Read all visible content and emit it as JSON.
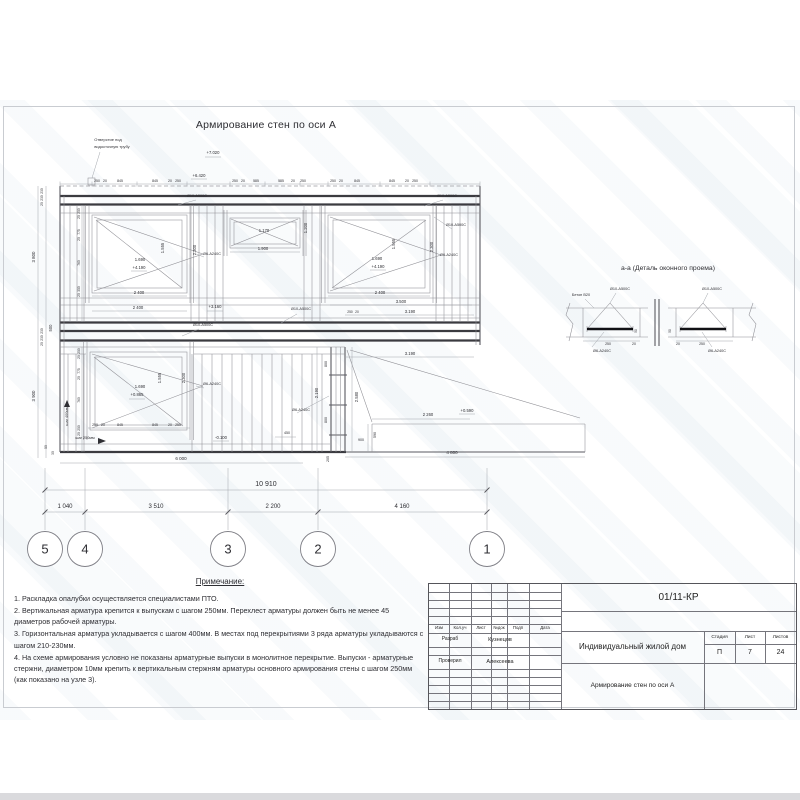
{
  "drawing": {
    "title": "Армирование стен по оси А",
    "labels": [
      [
        "Отверстие под",
        108,
        141,
        {
          "s": 4
        }
      ],
      [
        "водосточную трубу",
        112,
        148,
        {
          "s": 4
        }
      ],
      [
        "+7.020",
        213,
        154
      ],
      [
        "+6.420",
        199,
        177
      ],
      [
        "250",
        97,
        182,
        {
          "s": 3.5
        }
      ],
      [
        "20",
        105,
        182,
        {
          "s": 3.5
        }
      ],
      [
        "845",
        120,
        182,
        {
          "s": 3.5
        }
      ],
      [
        "845",
        155,
        182,
        {
          "s": 3.5
        }
      ],
      [
        "20",
        170,
        182,
        {
          "s": 3.5
        }
      ],
      [
        "250",
        178,
        182,
        {
          "s": 3.5
        }
      ],
      [
        "250",
        235,
        182,
        {
          "s": 3.5
        }
      ],
      [
        "20",
        243,
        182,
        {
          "s": 3.5
        }
      ],
      [
        "585",
        256,
        182,
        {
          "s": 3.5
        }
      ],
      [
        "585",
        281,
        182,
        {
          "s": 3.5
        }
      ],
      [
        "20",
        293,
        182,
        {
          "s": 3.5
        }
      ],
      [
        "250",
        303,
        182,
        {
          "s": 3.5
        }
      ],
      [
        "250",
        333,
        182,
        {
          "s": 3.5
        }
      ],
      [
        "20",
        341,
        182,
        {
          "s": 3.5
        }
      ],
      [
        "845",
        357,
        182,
        {
          "s": 3.5
        }
      ],
      [
        "845",
        392,
        182,
        {
          "s": 3.5
        }
      ],
      [
        "20",
        407,
        182,
        {
          "s": 3.5
        }
      ],
      [
        "250",
        415,
        182,
        {
          "s": 3.5
        }
      ],
      [
        "Ø10-A500C",
        197,
        197,
        {
          "s": 3.8
        }
      ],
      [
        "Ø10-A500C",
        447,
        197,
        {
          "s": 3.8
        }
      ],
      [
        "Ø10-A500C",
        456,
        226,
        {
          "s": 3.8
        }
      ],
      [
        "Ø6-A240C",
        449,
        256,
        {
          "s": 3.8
        }
      ],
      [
        "Ø6-A240C",
        212,
        255,
        {
          "s": 3.8
        }
      ],
      [
        "1.555",
        164,
        248,
        {
          "r": 1
        }
      ],
      [
        "2.300",
        196,
        250,
        {
          "r": 1
        }
      ],
      [
        "1.690",
        140,
        261
      ],
      [
        "+4.190",
        139,
        269
      ],
      [
        "2 400",
        139,
        294
      ],
      [
        "1.170",
        264,
        232
      ],
      [
        "1.900",
        263,
        250
      ],
      [
        "1.200",
        307,
        228,
        {
          "r": 1
        }
      ],
      [
        "1.555",
        395,
        244,
        {
          "r": 1
        }
      ],
      [
        "2.300",
        433,
        247,
        {
          "r": 1
        }
      ],
      [
        "1.690",
        377,
        260
      ],
      [
        "+4.190",
        378,
        268
      ],
      [
        "2 400",
        380,
        294
      ],
      [
        "2 400",
        138,
        309
      ],
      [
        "+3.160",
        215,
        308
      ],
      [
        "3.500",
        401,
        303
      ],
      [
        "250",
        350,
        313,
        {
          "s": 3.3
        }
      ],
      [
        "20",
        357,
        313,
        {
          "s": 3.3
        }
      ],
      [
        "3.190",
        410,
        313
      ],
      [
        "Ø10-A500C",
        301,
        310,
        {
          "s": 3.8
        }
      ],
      [
        "230",
        43,
        191,
        {
          "r": 1,
          "s": 3.3
        }
      ],
      [
        "230",
        43,
        198,
        {
          "r": 1,
          "s": 3.3
        }
      ],
      [
        "20",
        43,
        204,
        {
          "r": 1,
          "s": 3.3
        }
      ],
      [
        "3 800",
        35,
        257,
        {
          "r": 1,
          "s": 4.4
        }
      ],
      [
        "500",
        52,
        328,
        {
          "r": 1
        }
      ],
      [
        "230",
        43,
        331,
        {
          "r": 1,
          "s": 3.3
        }
      ],
      [
        "230",
        43,
        338,
        {
          "r": 1,
          "s": 3.3
        }
      ],
      [
        "20",
        43,
        344,
        {
          "r": 1,
          "s": 3.3
        }
      ],
      [
        "3 900",
        35,
        396,
        {
          "r": 1,
          "s": 4.4
        }
      ],
      [
        "50",
        47,
        447,
        {
          "r": 1,
          "s": 3.3
        }
      ],
      [
        "30",
        54,
        453,
        {
          "r": 1,
          "s": 3.3
        }
      ],
      [
        "250",
        80,
        211,
        {
          "r": 1,
          "s": 3.3
        }
      ],
      [
        "20",
        80,
        217,
        {
          "r": 1,
          "s": 3.3
        }
      ],
      [
        "775",
        80,
        232,
        {
          "r": 1,
          "s": 3.3
        }
      ],
      [
        "20",
        80,
        239,
        {
          "r": 1,
          "s": 3.3
        }
      ],
      [
        "760",
        80,
        263,
        {
          "r": 1,
          "s": 3.3
        }
      ],
      [
        "350",
        80,
        289,
        {
          "r": 1,
          "s": 3.3
        }
      ],
      [
        "20",
        80,
        295,
        {
          "r": 1,
          "s": 3.3
        }
      ],
      [
        "250",
        80,
        351,
        {
          "r": 1,
          "s": 3.3
        }
      ],
      [
        "20",
        80,
        357,
        {
          "r": 1,
          "s": 3.3
        }
      ],
      [
        "775",
        80,
        371,
        {
          "r": 1,
          "s": 3.3
        }
      ],
      [
        "20",
        80,
        378,
        {
          "r": 1,
          "s": 3.3
        }
      ],
      [
        "760",
        80,
        400,
        {
          "r": 1,
          "s": 3.3
        }
      ],
      [
        "250",
        80,
        428,
        {
          "r": 1,
          "s": 3.3
        }
      ],
      [
        "20",
        80,
        434,
        {
          "r": 1,
          "s": 3.3
        }
      ],
      [
        "Ø10-A500C",
        203,
        326,
        {
          "s": 3.8
        }
      ],
      [
        "1.555",
        161,
        378,
        {
          "r": 1
        }
      ],
      [
        "2.300",
        185,
        378,
        {
          "r": 1
        }
      ],
      [
        "1.690",
        140,
        388
      ],
      [
        "+0.865",
        137,
        396
      ],
      [
        "Ø6-A240C",
        212,
        385,
        {
          "s": 3.8
        }
      ],
      [
        "250",
        95,
        426,
        {
          "s": 3.5
        }
      ],
      [
        "20",
        103,
        426,
        {
          "s": 3.5
        }
      ],
      [
        "845",
        120,
        426,
        {
          "s": 3.5
        }
      ],
      [
        "845",
        155,
        426,
        {
          "s": 3.5
        }
      ],
      [
        "20",
        170,
        426,
        {
          "s": 3.5
        }
      ],
      [
        "250",
        178,
        426,
        {
          "s": 3.5
        }
      ],
      [
        "шаг 400мм",
        68,
        416,
        {
          "r": 1,
          "s": 3.8
        }
      ],
      [
        "шаг 250мм",
        85,
        439,
        {
          "s": 3.8
        }
      ],
      [
        "3.190",
        410,
        355
      ],
      [
        "2.190",
        318,
        393,
        {
          "r": 1
        }
      ],
      [
        "800",
        327,
        364,
        {
          "r": 1,
          "s": 3.6
        }
      ],
      [
        "800",
        327,
        420,
        {
          "r": 1,
          "s": 3.6
        }
      ],
      [
        "2.580",
        358,
        397,
        {
          "r": 1
        }
      ],
      [
        "900",
        361,
        441,
        {
          "s": 3.6
        }
      ],
      [
        "590",
        376,
        435,
        {
          "r": 1,
          "s": 3.6
        }
      ],
      [
        "2 260",
        428,
        416
      ],
      [
        "+0.590",
        467,
        412
      ],
      [
        "4 800",
        452,
        454,
        {
          "s": 4.5
        }
      ],
      [
        "450",
        287,
        434,
        {
          "s": 3.6
        }
      ],
      [
        "-0.100",
        221,
        439
      ],
      [
        "205",
        329,
        459,
        {
          "r": 1,
          "s": 3.6
        }
      ],
      [
        "Ø6-A240C",
        301,
        411,
        {
          "s": 3.8
        }
      ],
      [
        "6 000",
        181,
        460,
        {
          "s": 4.5
        }
      ],
      [
        "10 910",
        266,
        486,
        {
          "s": 7,
          "n": "overall-dimension"
        }
      ],
      [
        "1 040",
        65,
        508,
        {
          "s": 6
        }
      ],
      [
        "3 510",
        156,
        508,
        {
          "s": 6
        }
      ],
      [
        "2 200",
        273,
        508,
        {
          "s": 6
        }
      ],
      [
        "4 160",
        402,
        508,
        {
          "s": 6
        }
      ],
      [
        "Бетон B20",
        581,
        296,
        {
          "s": 3.8
        }
      ],
      [
        "Ø10-A500C",
        620,
        290,
        {
          "s": 3.8
        }
      ],
      [
        "Ø10-A500C",
        712,
        290,
        {
          "s": 3.8
        }
      ],
      [
        "Ø6-A240C",
        602,
        352,
        {
          "s": 3.8
        }
      ],
      [
        "Ø6-A240C",
        717,
        352,
        {
          "s": 3.8
        }
      ],
      [
        "250",
        608,
        345,
        {
          "s": 3.5
        }
      ],
      [
        "20",
        634,
        345,
        {
          "s": 3.5
        }
      ],
      [
        "20",
        678,
        345,
        {
          "s": 3.5
        }
      ],
      [
        "250",
        702,
        345,
        {
          "s": 3.5
        }
      ],
      [
        "50",
        637,
        331,
        {
          "r": 1,
          "s": 3.2
        }
      ],
      [
        "50",
        671,
        331,
        {
          "r": 1,
          "s": 3.2
        }
      ]
    ]
  },
  "detail": {
    "title": "а-а (Деталь оконного проема)"
  },
  "axes": {
    "circles": [
      {
        "n": "5",
        "x": 45
      },
      {
        "n": "4",
        "x": 85
      },
      {
        "n": "3",
        "x": 228
      },
      {
        "n": "2",
        "x": 318
      },
      {
        "n": "1",
        "x": 487
      }
    ]
  },
  "notes": {
    "title": "Примечание:",
    "items": [
      "1. Раскладка опалубки осуществляется специалистами ПТО.",
      "2. Вертикальная арматура крепится к выпускам с шагом 250мм. Перехлест арматуры должен быть не менее 45 диаметров рабочей арматуры.",
      "3. Горизонтальная арматура укладывается с шагом 400мм. В местах под перекрытиями 3 ряда арматуры укладываются с шагом 210-230мм.",
      "4. На схеме армирования условно не показаны арматурные выпуски в монолитное перекрытие. Выпуски - арматурные стержни, диаметром 10мм крепить к вертикальным стержням арматуры основного армирования стены с шагом 250мм (как показано на узле 3)."
    ]
  },
  "title_block": {
    "doc_number": "01/11-КР",
    "cols": [
      "Изм",
      "Кол.уч",
      "Лист",
      "№док",
      "Подп",
      "Дата"
    ],
    "rows": [
      {
        "role": "Разраб",
        "name": "Кузнецов"
      },
      {
        "role": "Проверил",
        "name": "Алексеева"
      }
    ],
    "project": "Индивидуальный жилой дом",
    "stage_cols": [
      "Стадия",
      "Лист",
      "Листов"
    ],
    "stage_vals": [
      "П",
      "7",
      "24"
    ],
    "sheet_title": "Армирование стен по оси А"
  }
}
